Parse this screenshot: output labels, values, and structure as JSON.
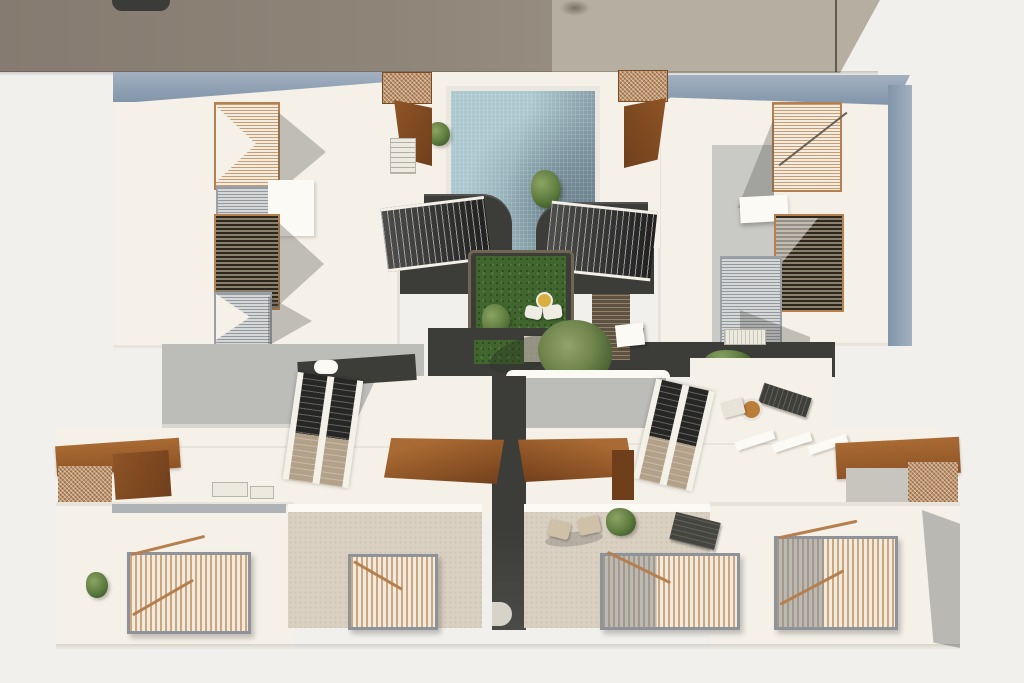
{
  "scene": {
    "type": "architectural-aerial-render",
    "view": "top-down bird's eye of residential complex",
    "text_visible": "none",
    "areas": {
      "neighbor_roofs": [
        "dark-taupe-roof-west",
        "light-greige-roof-east",
        "rooftop-vehicle"
      ],
      "north_buildings": {
        "left": {
          "skylight_louvers": 3,
          "parapet_color_key": "parapet"
        },
        "right": {
          "skylight_louvers": 3,
          "parapet_color_key": "parapet"
        }
      },
      "pool_courtyard": {
        "pool": "tiled water basin",
        "lawn_patches": 2,
        "pool_side_stairs": 2,
        "corten_stair_boxes": 2,
        "poufs": 2,
        "round_table": 1,
        "tree": 1
      },
      "mid_level": {
        "gray_walkways": 2,
        "double_stair_flights": 2,
        "charcoal_paths": 2,
        "lounger": 1,
        "side_table": 1,
        "shrubs": 3,
        "bench": 1,
        "boardwalk": 1
      },
      "lower_row": {
        "corten_pergolas": 4,
        "white_units": 2,
        "tiled_patios": 2,
        "wood_slat_pergolas": 4,
        "patio_chairs": 2,
        "sun_lounger": 1,
        "patio_plants": 2
      }
    },
    "palette": {
      "ground": "#f2f0ec",
      "roofDark": "#8e8478",
      "roofLight": "#b6aea0",
      "white": "#f5f1e8",
      "whiteBright": "#fcfaf4",
      "parapet": "#a3b0c0",
      "parapetDark": "#8195aa",
      "woodFrame": "#b67f4e",
      "woodSlat": "#cba67e",
      "corten": "#8e5426",
      "cortenDark": "#6f3f1c",
      "cortenMesh": "#bf9166",
      "charcoal": "#3c3c39",
      "poolLight": "#abc8cf",
      "poolDark": "#708795",
      "coping": "#e9e7e0",
      "lawn": "#40652e",
      "walkway": "#bcbcb9",
      "walkwayLight": "#d9d7d2",
      "tile": "#d9d0c1",
      "steel": "#8d9399",
      "treeGreen": "#7b9157",
      "treeDark": "#4c6334",
      "treadTan": "#b2a188",
      "vehicleDark": "#3b3b39",
      "yellow": "#d8ae3e"
    }
  }
}
